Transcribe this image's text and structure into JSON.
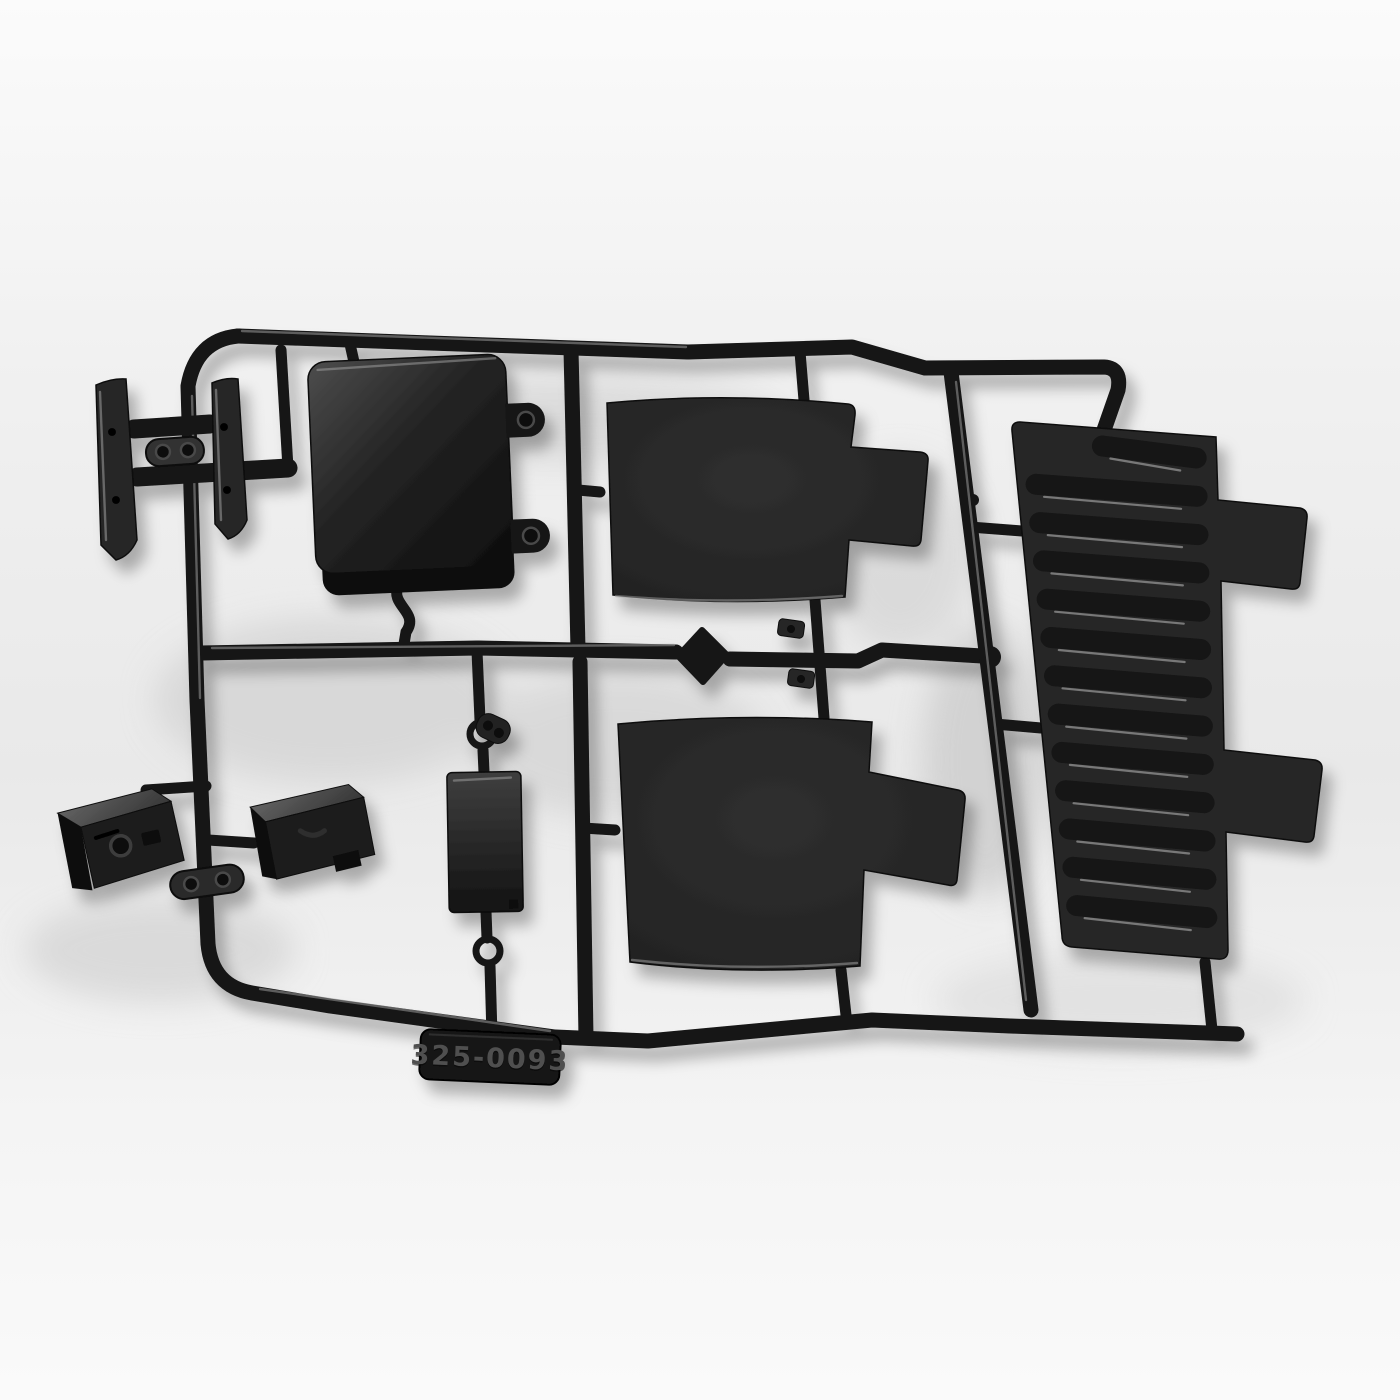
{
  "photo": {
    "subject": "black-plastic-injection-molded-parts-tree",
    "part_number_label": "325-0093",
    "colors": {
      "background": "#eeeeee",
      "plastic": "#131313",
      "panel": "#282828",
      "rib": "#151515",
      "sheen": "#9a9a9a",
      "top_face": "#555555",
      "tag": "#191919",
      "tag_text": "#505050",
      "blob": "#d6d6d6"
    },
    "louver": {
      "rib_count": 13
    },
    "parts": [
      {
        "name": "bumper-blade-left"
      },
      {
        "name": "bumper-blade-right"
      },
      {
        "name": "link-bracket-two-hole"
      },
      {
        "name": "receiver-box"
      },
      {
        "name": "flat-panel-upper"
      },
      {
        "name": "flat-panel-lower"
      },
      {
        "name": "louvered-panel"
      },
      {
        "name": "jerry-can"
      },
      {
        "name": "storage-box"
      },
      {
        "name": "flat-plate"
      },
      {
        "name": "mold-number-tag"
      }
    ]
  }
}
